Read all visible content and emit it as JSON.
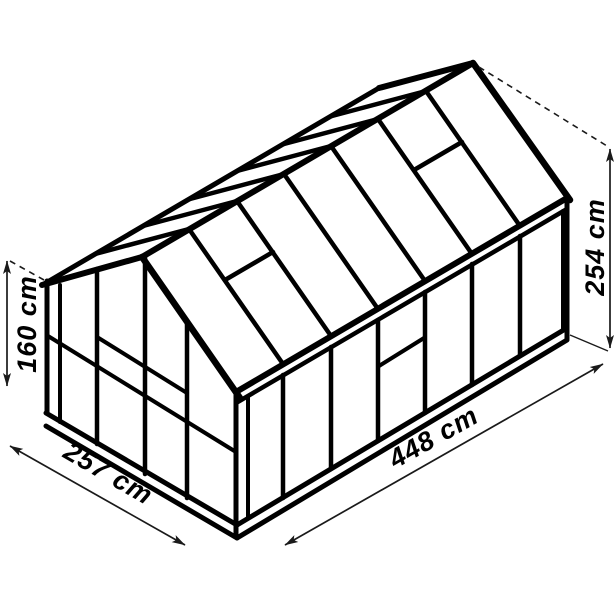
{
  "diagram": {
    "subject": "greenhouse-isometric-dimension-drawing",
    "background_color": "#ffffff",
    "line_color": "#000000",
    "dimension_line_color": "#1a1a1a",
    "labels": {
      "left_height": "160 cm",
      "total_height": "254 cm",
      "front_width": "257 cm",
      "side_length": "448 cm"
    }
  }
}
